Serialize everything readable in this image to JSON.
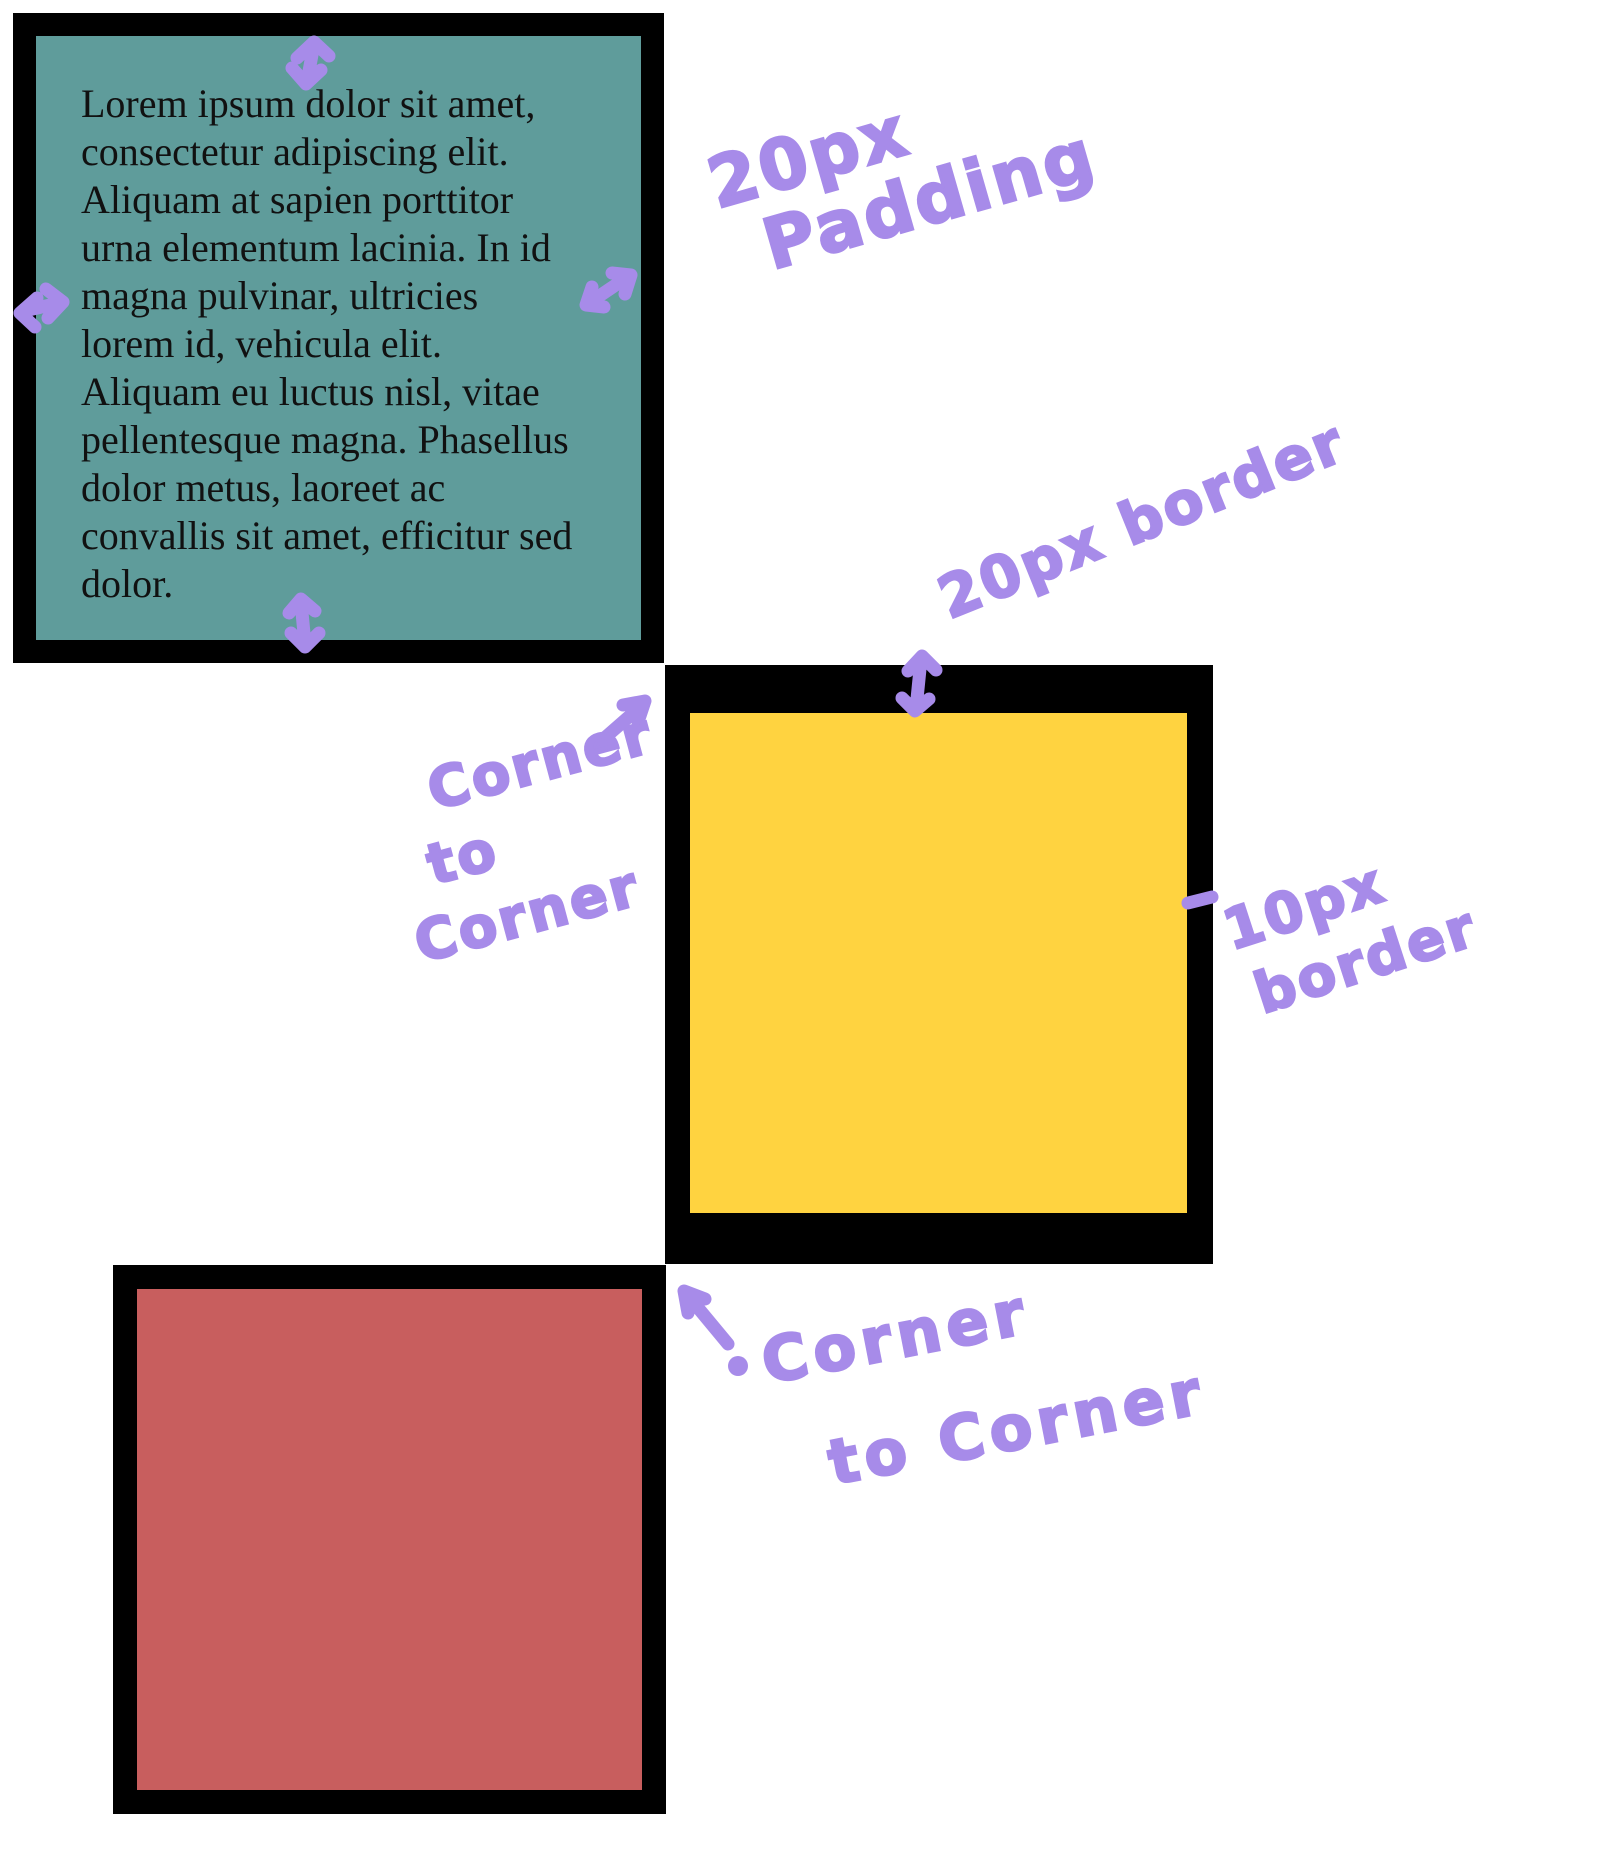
{
  "colors": {
    "background": "#ffffff",
    "ink-black": "#000000",
    "teal": "#5f9c9b",
    "yellow": "#ffd340",
    "red": "#c85e5e",
    "purple": "#a78be9",
    "text": "#111111"
  },
  "teal_box": {
    "lines": [
      "Lorem ipsum dolor sit amet,",
      "consectetur adipiscing elit.",
      "Aliquam at sapien porttitor",
      "urna elementum lacinia. In id",
      "magna pulvinar, ultricies",
      "lorem id, vehicula elit.",
      "Aliquam eu luctus nisl, vitae",
      "pellentesque magna. Phasellus",
      "dolor metus, laoreet ac",
      "convallis sit amet, efficitur sed",
      "dolor."
    ]
  },
  "annotations": {
    "padding": {
      "line1": "20px",
      "line2": "Padding"
    },
    "border20": {
      "label": "20px border"
    },
    "border10": {
      "line1": "10px",
      "line2": "border"
    },
    "corner1": {
      "line1": "Corner",
      "line2": "to",
      "line3": "Corner"
    },
    "corner2": {
      "line1": "Corner",
      "line2": "to Corner"
    }
  }
}
